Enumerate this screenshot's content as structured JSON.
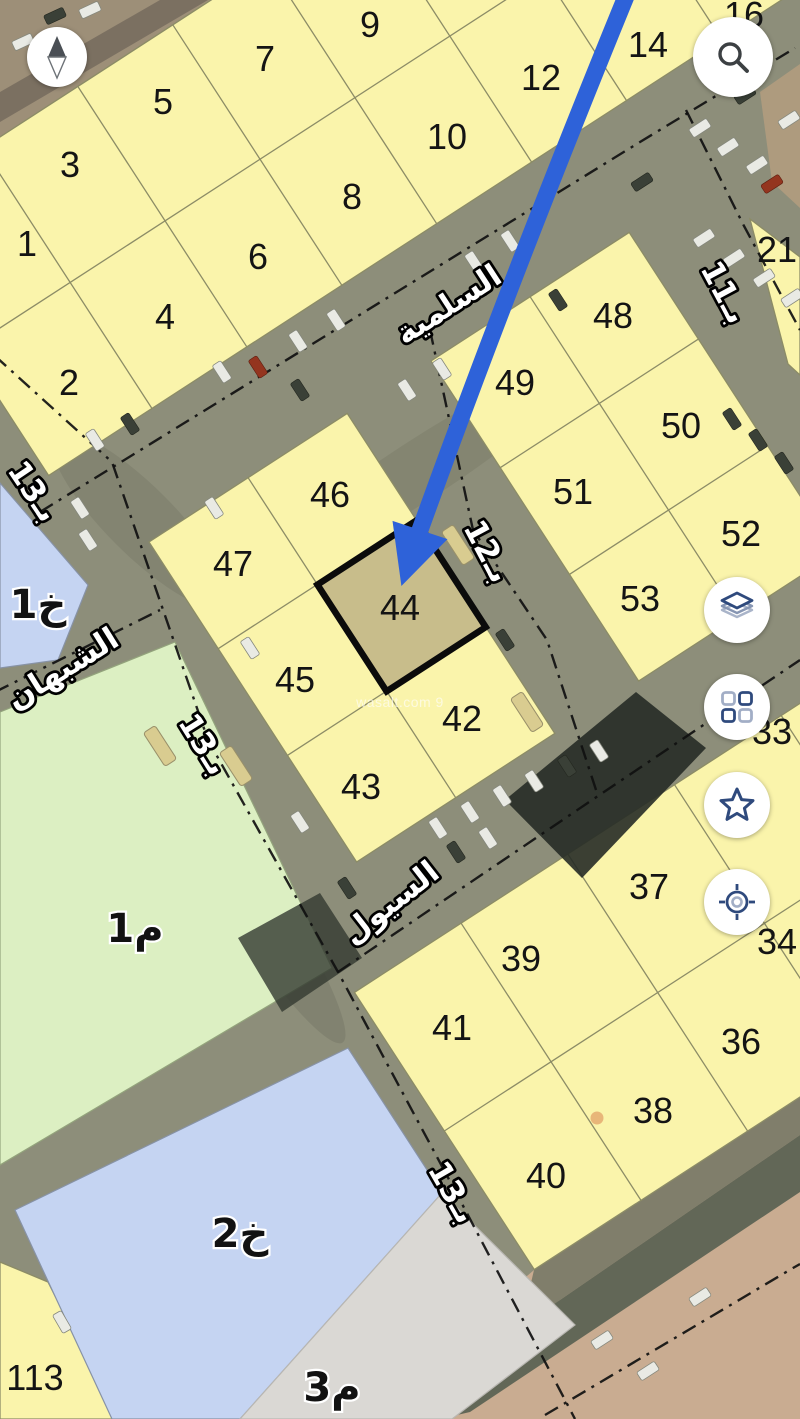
{
  "map": {
    "watermark": "wasalt.com 9",
    "highlighted_plot": "44",
    "plot_labels": [
      {
        "label": "1",
        "x": 27,
        "y": 243
      },
      {
        "label": "2",
        "x": 69,
        "y": 382
      },
      {
        "label": "3",
        "x": 70,
        "y": 164
      },
      {
        "label": "4",
        "x": 165,
        "y": 316
      },
      {
        "label": "5",
        "x": 163,
        "y": 101
      },
      {
        "label": "6",
        "x": 258,
        "y": 256
      },
      {
        "label": "7",
        "x": 265,
        "y": 58
      },
      {
        "label": "8",
        "x": 352,
        "y": 196
      },
      {
        "label": "9",
        "x": 370,
        "y": 24
      },
      {
        "label": "10",
        "x": 447,
        "y": 136
      },
      {
        "label": "12",
        "x": 541,
        "y": 77
      },
      {
        "label": "14",
        "x": 648,
        "y": 44
      },
      {
        "label": "16",
        "x": 744,
        "y": 14
      },
      {
        "label": "21",
        "x": 777,
        "y": 249
      },
      {
        "label": "33",
        "x": 772,
        "y": 731
      },
      {
        "label": "34",
        "x": 777,
        "y": 941
      },
      {
        "label": "36",
        "x": 741,
        "y": 1041
      },
      {
        "label": "37",
        "x": 649,
        "y": 886
      },
      {
        "label": "38",
        "x": 653,
        "y": 1110
      },
      {
        "label": "39",
        "x": 521,
        "y": 958
      },
      {
        "label": "40",
        "x": 546,
        "y": 1175
      },
      {
        "label": "41",
        "x": 452,
        "y": 1027
      },
      {
        "label": "42",
        "x": 462,
        "y": 718
      },
      {
        "label": "43",
        "x": 361,
        "y": 786
      },
      {
        "label": "44",
        "x": 400,
        "y": 607
      },
      {
        "label": "45",
        "x": 295,
        "y": 679
      },
      {
        "label": "46",
        "x": 330,
        "y": 494
      },
      {
        "label": "47",
        "x": 233,
        "y": 563
      },
      {
        "label": "48",
        "x": 613,
        "y": 315
      },
      {
        "label": "49",
        "x": 515,
        "y": 382
      },
      {
        "label": "50",
        "x": 681,
        "y": 425
      },
      {
        "label": "51",
        "x": 573,
        "y": 491
      },
      {
        "label": "52",
        "x": 741,
        "y": 533
      },
      {
        "label": "53",
        "x": 640,
        "y": 598
      },
      {
        "label": "113",
        "x": 35,
        "y": 1377
      }
    ],
    "area_labels": [
      {
        "label": "خ1",
        "x": 38,
        "y": 604
      },
      {
        "label": "م1",
        "x": 135,
        "y": 928
      },
      {
        "label": "خ2",
        "x": 240,
        "y": 1233
      },
      {
        "label": "م3",
        "x": 332,
        "y": 1387
      }
    ],
    "street_labels": [
      {
        "label": "السلمية",
        "x": 448,
        "y": 304,
        "rotate": -33
      },
      {
        "label": "الشبهان",
        "x": 62,
        "y": 668,
        "rotate": -32
      },
      {
        "label": "السيول",
        "x": 390,
        "y": 902,
        "rotate": -38
      },
      {
        "label": "بـ11",
        "x": 725,
        "y": 292,
        "rotate": 62
      },
      {
        "label": "بـ12",
        "x": 488,
        "y": 551,
        "rotate": 62
      },
      {
        "label": "بـ13",
        "x": 34,
        "y": 491,
        "rotate": 56
      },
      {
        "label": "بـ13",
        "x": 204,
        "y": 744,
        "rotate": 58
      },
      {
        "label": "بـ13",
        "x": 453,
        "y": 1192,
        "rotate": 60
      }
    ],
    "colors": {
      "parcel": "#FAF4AB",
      "parcel_border": "#8C8C66",
      "highlight_fill": "#C8BD8B",
      "highlight_border": "#0B0B0B",
      "blue_zone": "#C5D4F2",
      "green_zone": "#DCEFC2",
      "gray_zone": "#DAD8D4",
      "arrow": "#2E62D9",
      "label": "#141414"
    }
  },
  "controls": {
    "compass": {
      "icon": "compass-needle"
    },
    "search": {
      "icon": "magnifier"
    },
    "layers": {
      "icon": "map-layers"
    },
    "apps_grid": {
      "icon": "grid-squares"
    },
    "favorites": {
      "icon": "star"
    },
    "my_location": {
      "icon": "gps-target"
    }
  }
}
